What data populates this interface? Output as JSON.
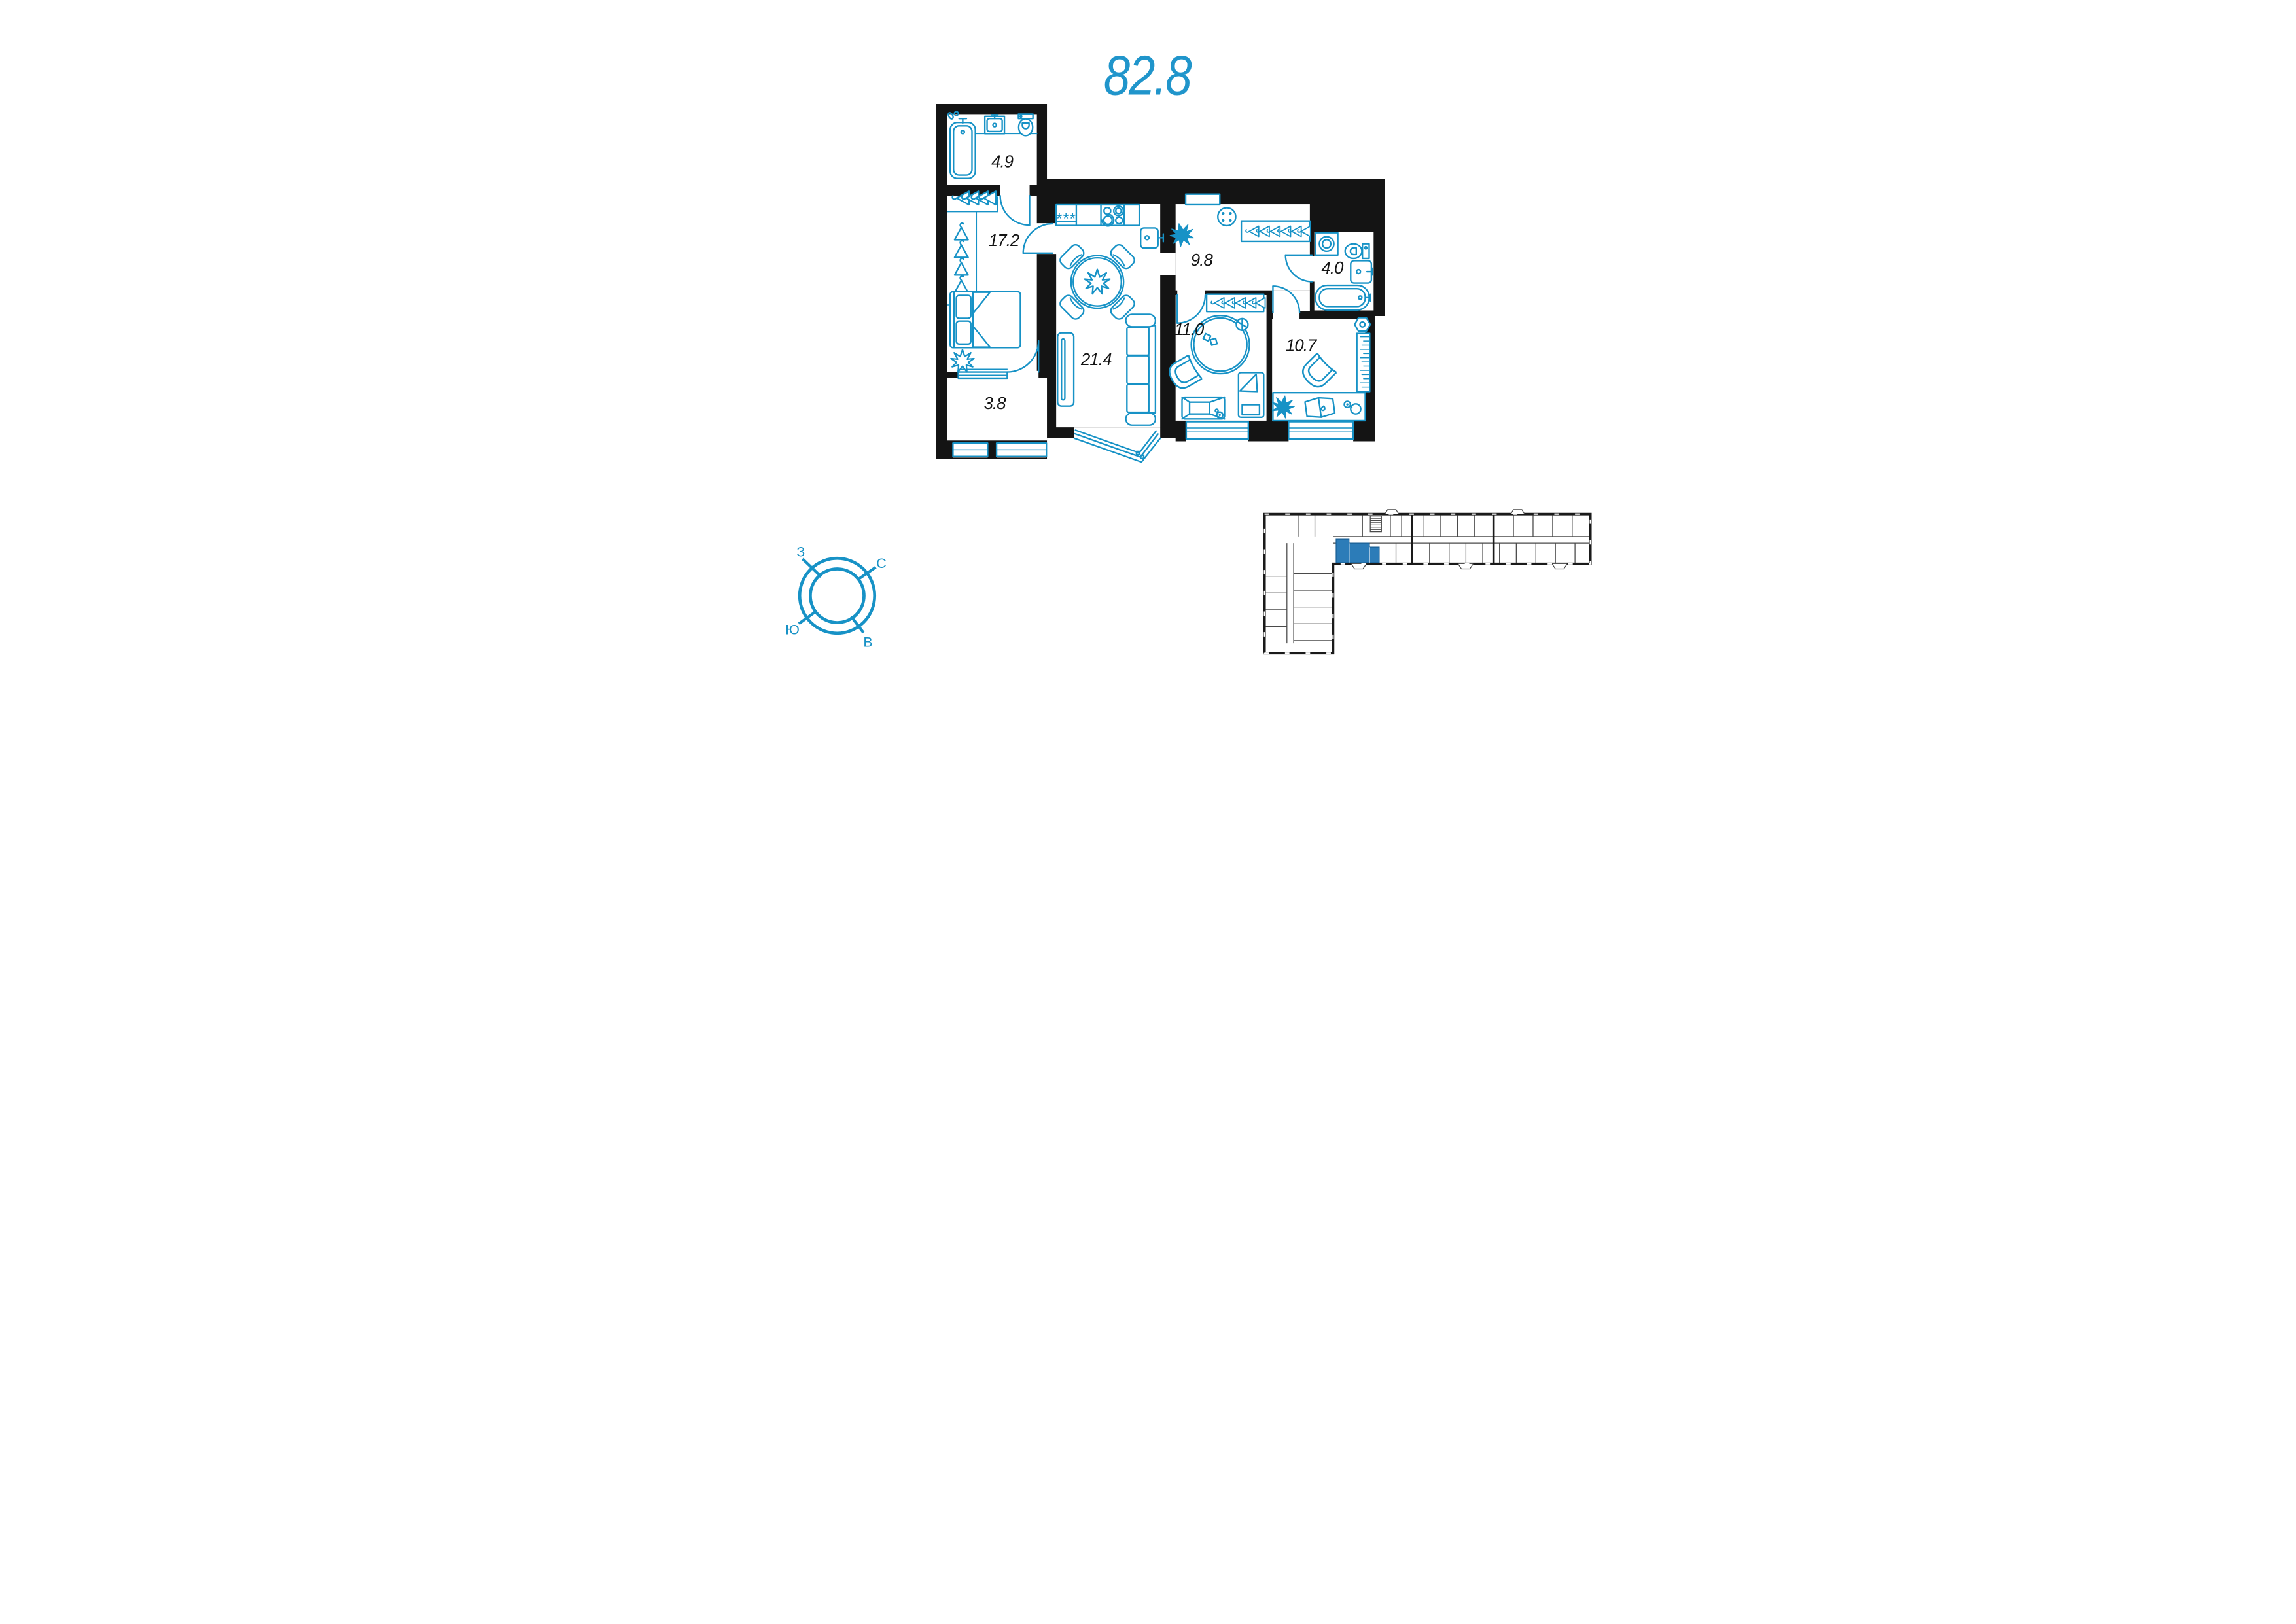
{
  "title": {
    "area_value": "82.8"
  },
  "floor_plan": {
    "rooms": {
      "bathroom_top": {
        "area_label": "4.9"
      },
      "bedroom": {
        "area_label": "17.2"
      },
      "balcony": {
        "area_label": "3.8"
      },
      "living_kitchen": {
        "area_label": "21.4"
      },
      "hallway": {
        "area_label": "9.8"
      },
      "bathroom_right": {
        "area_label": "4.0"
      },
      "nursery": {
        "area_label": "11.0"
      },
      "study": {
        "area_label": "10.7"
      }
    },
    "fridge_symbol": "***"
  },
  "compass": {
    "west": "З",
    "north": "С",
    "south": "Ю",
    "east": "В"
  },
  "colors": {
    "plan_blue": "#1792C6",
    "title_blue": "#2095CB",
    "wall_black": "#141414",
    "minimap_outline": "#1A1A1A",
    "minimap_highlight": "#2C7CB8"
  }
}
